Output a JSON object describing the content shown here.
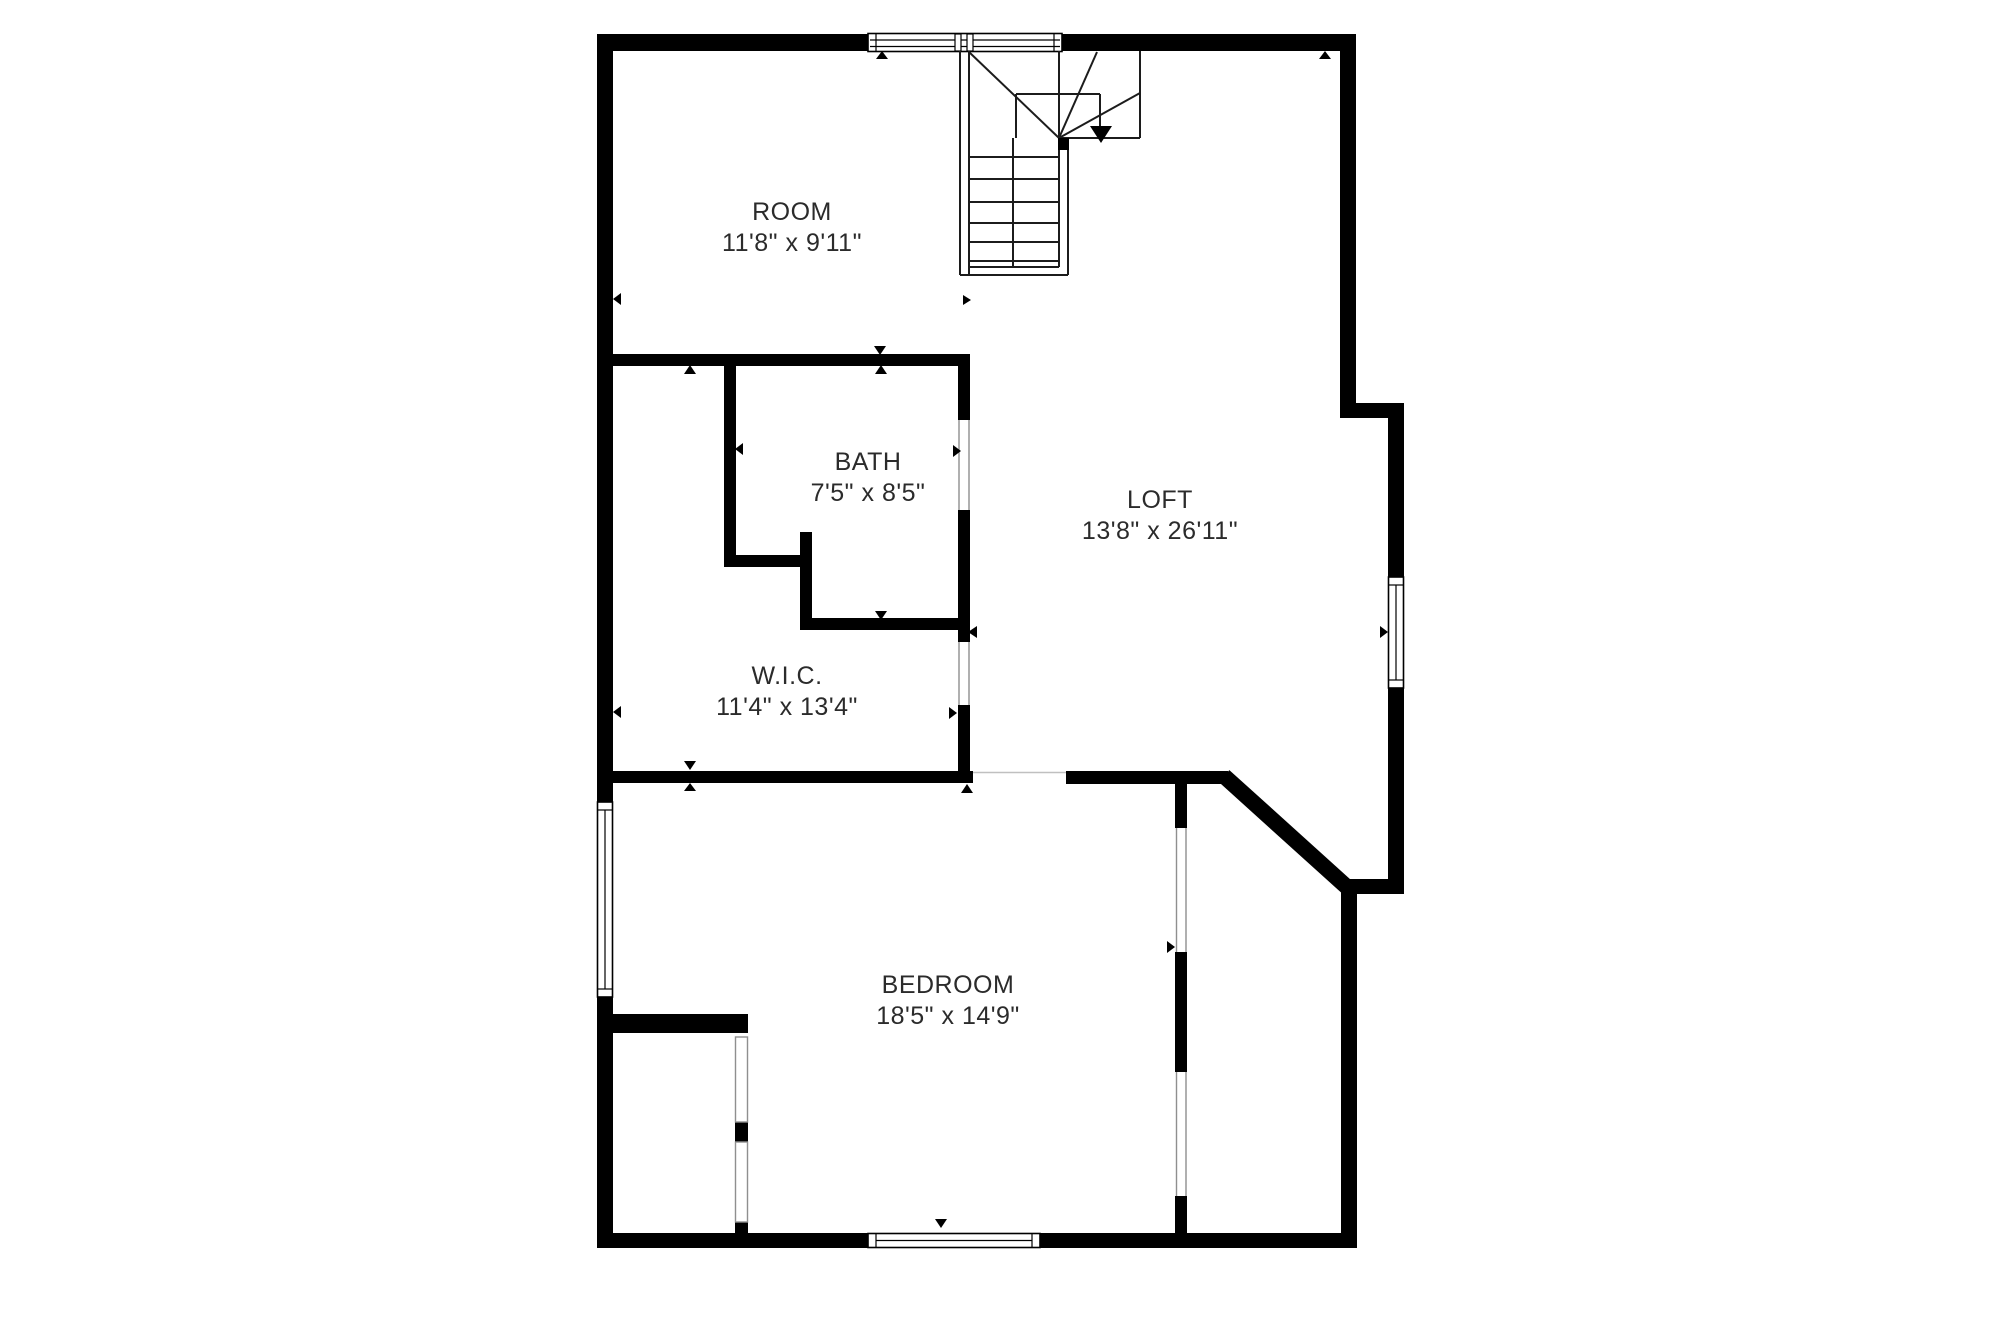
{
  "page": {
    "background": "#ffffff"
  },
  "colors": {
    "wall": "#000000",
    "stair_line": "#1c1c1c",
    "door_jamb": "#8f8f8f",
    "marker": "#000000",
    "text": "#2b2b2b"
  },
  "rooms": [
    {
      "name": "ROOM",
      "dims": "11'8\" x 9'11\""
    },
    {
      "name": "BATH",
      "dims": "7'5\" x 8'5\""
    },
    {
      "name": "LOFT",
      "dims": "13'8\" x 26'11\""
    },
    {
      "name": "W.I.C.",
      "dims": "11'4\" x 13'4\""
    },
    {
      "name": "BEDROOM",
      "dims": "18'5\" x 14'9\""
    }
  ]
}
